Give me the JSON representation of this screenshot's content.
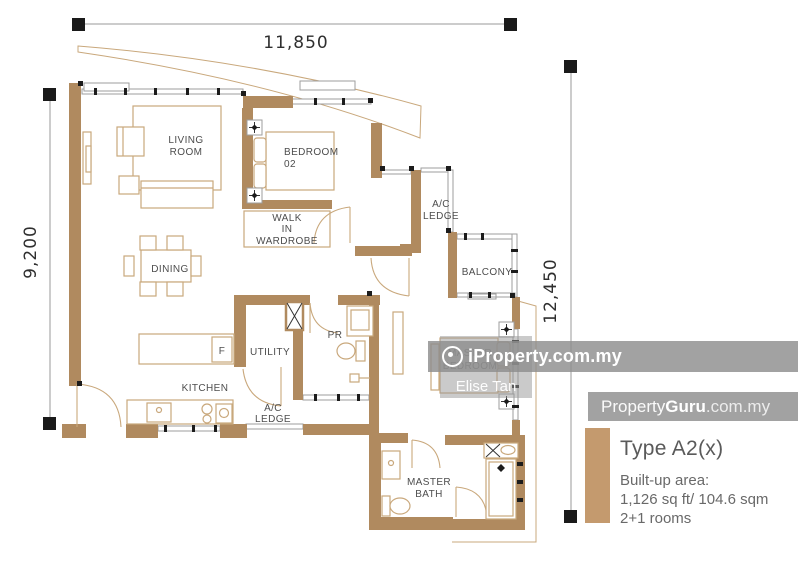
{
  "dimensions": {
    "top": "11,850",
    "left": "9,200",
    "right": "12,450"
  },
  "rooms": {
    "living": {
      "line1": "LIVING",
      "line2": "ROOM"
    },
    "bedroom02": {
      "line1": "BEDROOM",
      "line2": "02"
    },
    "wardrobe": {
      "line1": "WALK",
      "line2": "IN",
      "line3": "WARDROBE"
    },
    "dining": {
      "label": "DINING"
    },
    "ac_ledge_top": {
      "line1": "A/C",
      "line2": "LEDGE"
    },
    "balcony": {
      "label": "BALCONY"
    },
    "utility": {
      "label": "UTILITY"
    },
    "pr": {
      "label": "PR"
    },
    "kitchen": {
      "label": "KITCHEN"
    },
    "fridge": {
      "label": "F"
    },
    "ac_ledge_bottom": {
      "line1": "A/C",
      "line2": "LEDGE"
    },
    "master_bedroom": {
      "line1": "MASTER",
      "line2": "BEDROOM"
    },
    "master_bath": {
      "line1": "MASTER",
      "line2": "BATH"
    }
  },
  "watermarks": {
    "iproperty": "iProperty.com.my",
    "agent": "Elise Tan",
    "pg_property": "Property",
    "pg_guru": "Guru",
    "pg_suffix": ".com.my"
  },
  "legend": {
    "type": "Type A2(x)",
    "builtup_label": "Built-up area:",
    "area": "1,126 sq ft/ 104.6 sqm",
    "rooms": "2+1 rooms"
  },
  "colors": {
    "wall": "#b08a5f",
    "furn": "#c9a87c",
    "line": "#9e9e9e",
    "text": "#4d4d4d",
    "legendbar": "#c49a6e",
    "dim": "#2f2f2f"
  }
}
